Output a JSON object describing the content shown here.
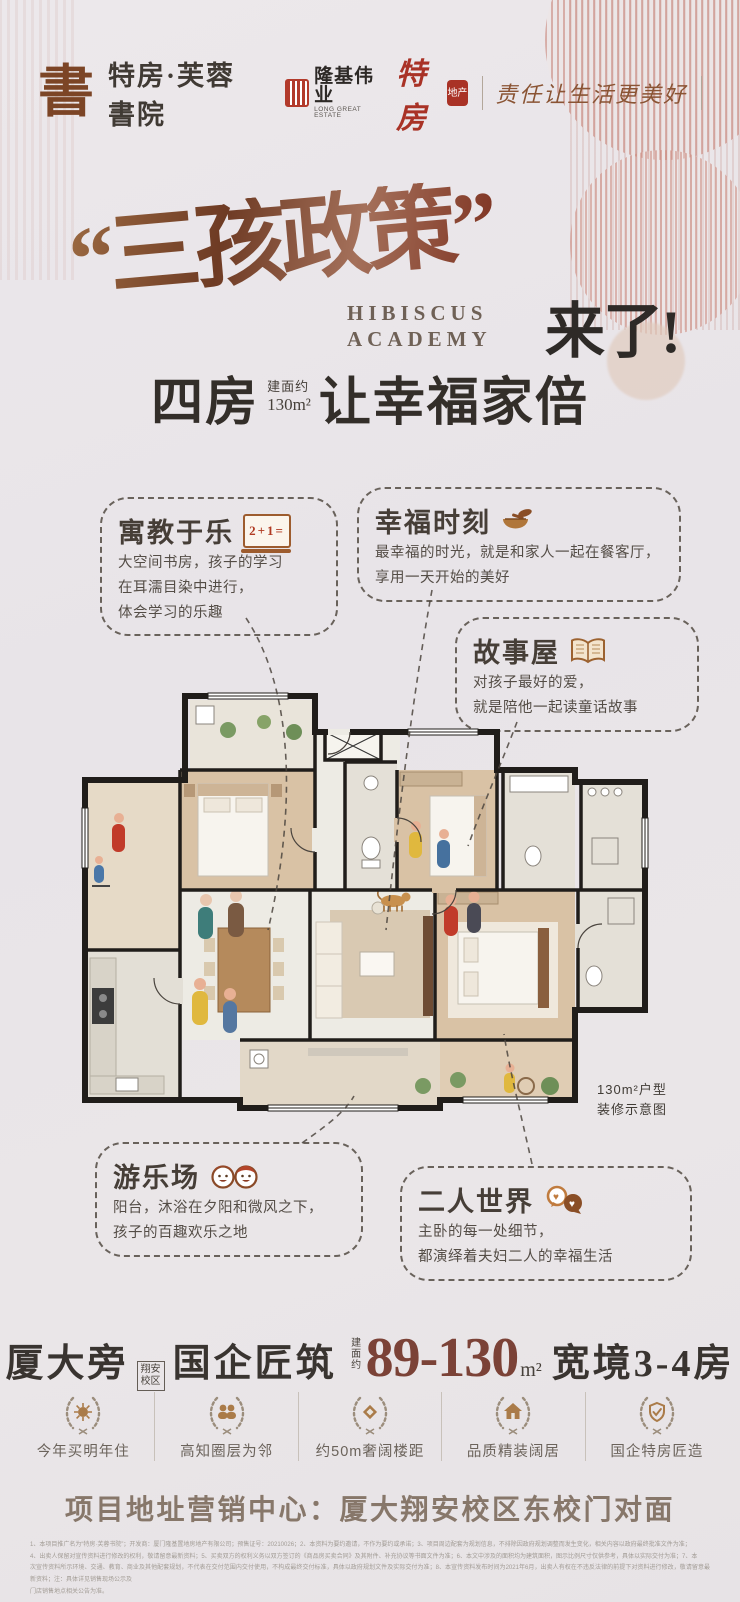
{
  "header": {
    "logo_glyph": "書",
    "brand_name": "特房·芙蓉書院",
    "partner_name": "隆基伟业",
    "partner_sub": "LONG GREAT ESTATE",
    "developer_name": "特房",
    "developer_seal": "地产",
    "slogan": "责任让生活更美好"
  },
  "hero": {
    "quoted_title": "“三孩政策”",
    "en_line1": "HIBISCUS",
    "en_line2": "ACADEMY",
    "suffix": "来了!",
    "rooms": "四房",
    "area_label": "建面约",
    "area_value": "130m²",
    "tagline": "让幸福家倍"
  },
  "callouts": {
    "study": {
      "title": "寓教于乐",
      "board_text": "2+1=",
      "lines": [
        "大空间书房，孩子的学习",
        "在耳濡目染中进行，",
        "体会学习的乐趣"
      ]
    },
    "moment": {
      "title": "幸福时刻",
      "lines": [
        "最幸福的时光，就是和家人一起在餐客厅，",
        "享用一天开始的美好"
      ]
    },
    "story": {
      "title": "故事屋",
      "lines": [
        "对孩子最好的爱，",
        "就是陪他一起读童话故事"
      ]
    },
    "play": {
      "title": "游乐场",
      "lines": [
        "阳台，沐浴在夕阳和微风之下，",
        "孩子的百趣欢乐之地"
      ]
    },
    "couple": {
      "title": "二人世界",
      "lines": [
        "主卧的每一处细节，",
        "都演绎着夫妇二人的幸福生活"
      ]
    }
  },
  "floorplan": {
    "caption1": "130m²户型",
    "caption2": "装修示意图"
  },
  "specs": {
    "location": "厦大旁",
    "tag1": "翔安",
    "tag2": "校区",
    "builder": "国企匠筑",
    "area_label": "建面约",
    "area_range": "89-130",
    "area_unit": "m²",
    "layout": "宽境3-4房"
  },
  "badges": [
    {
      "label": "今年买明年住"
    },
    {
      "label": "高知圈层为邻"
    },
    {
      "label": "约50m奢阔楼距"
    },
    {
      "label": "品质精装阔居"
    },
    {
      "label": "国企特房匠造"
    }
  ],
  "address": {
    "text": "项目地址营销中心：厦大翔安校区东校门对面"
  },
  "disclaimer": {
    "lines": [
      "1、本项目推广名为“特房·芙蓉书院”；开发商：厦门隆基置地房地产有限公司；预售证号：20210026；2、本资料为要约邀请，不作为要约或承诺；3、项目周边配套为规划信息，不排除因政府规划调整而发生变化，相关内容以政府最终批准文件为准；",
      "4、出卖人保留对宣传资料进行修改的权利，敬请留意最新资料；5、买卖双方的权利义务以双方签订的《商品房买卖合同》及其附件、补充协议等书面文件为准；6、本文中涉及的面积均为建筑面积，图示比例尺寸仅供参考，具体以实际交付为准；7、本",
      "次宣传资料所示环境、交通、教育、商业及其他配套规划，不代表在交付范围内交付使用，不构成最终交付标准，具体以政府规划文件及实际交付为准；8、本宣传资料发布时间为2021年6月，出卖人有权在不违反法律的前提下对资料进行修改，敬请留意最新资料；注：具体详见销售现场公示及",
      "门店销售地点相关公告为准。"
    ]
  }
}
